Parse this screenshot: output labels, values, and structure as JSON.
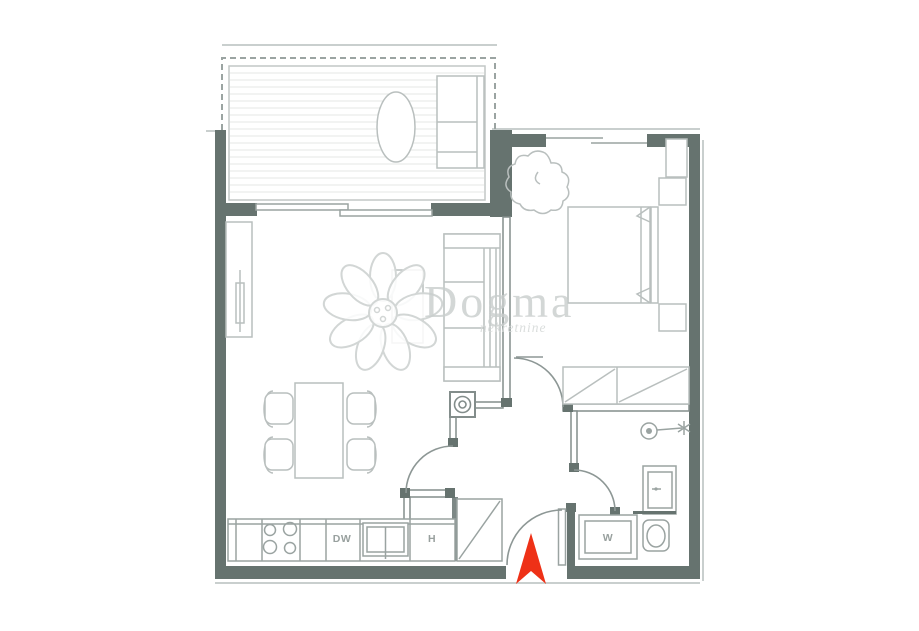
{
  "plan": {
    "kind": "apartment-floor-plan",
    "watermark": {
      "brand": "Dogma",
      "tagline": "nekretnine"
    },
    "labels": {
      "dishwasher": "DW",
      "hood": "H",
      "washing_machine": "W"
    },
    "colors": {
      "wall": "#66736f",
      "interior_wall": "#838d8b",
      "furniture_outline": "#b9bfbe",
      "fixture_outline": "#9aa3a1",
      "deck_line": "#e4e7e6",
      "sill_line": "#c9cfce",
      "watermark_text": "#c9cecd",
      "entrance_arrow": "#ee3117",
      "background": "#ffffff"
    },
    "fixtures": [
      "balcony-deck",
      "balcony-table",
      "balcony-bench",
      "sliding-door",
      "tv-unit",
      "sofa",
      "coffee-table",
      "dining-table",
      "dining-chairs",
      "cooktop",
      "kitchen-sink",
      "tall-cabinet",
      "boiler",
      "double-bed",
      "nightstands",
      "wardrobe",
      "plant",
      "bedroom-window",
      "shower-head",
      "vanity-sink",
      "toilet",
      "entrance-arrow"
    ]
  }
}
